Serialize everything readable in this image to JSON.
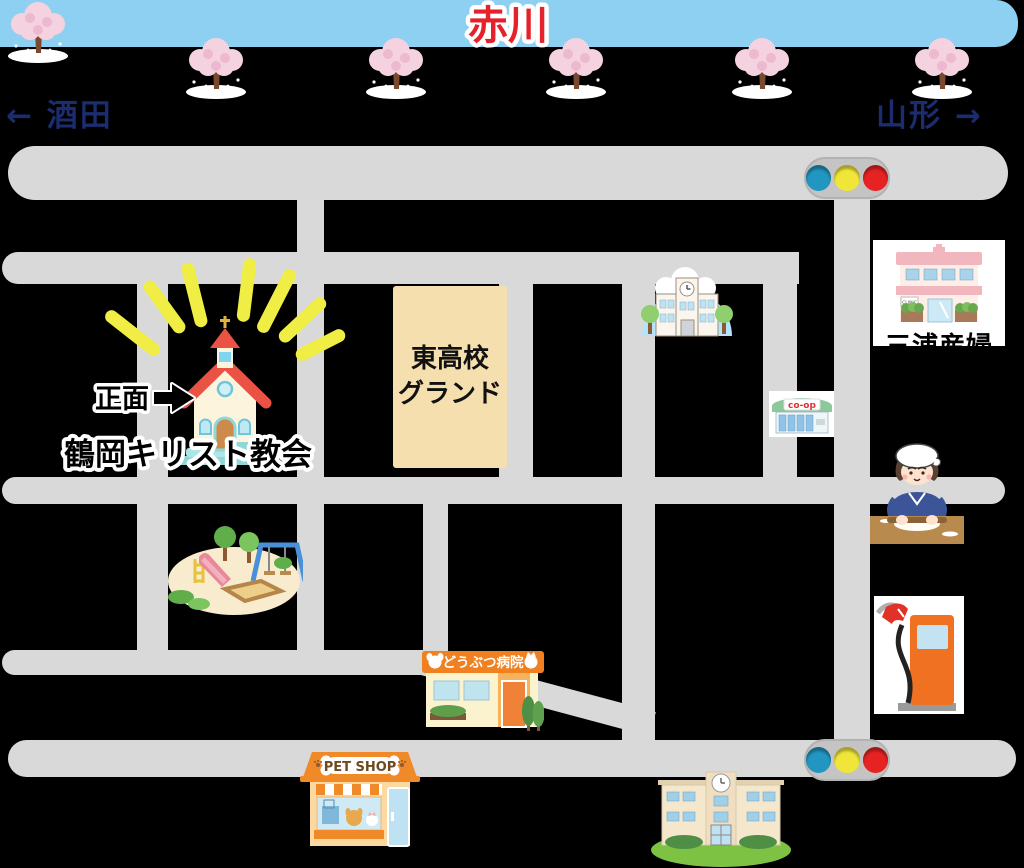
{
  "header": {
    "river": "赤川",
    "left_direction": "← 酒田",
    "right_direction": "山形 →"
  },
  "places": {
    "church": {
      "name": "鶴岡キリスト教会",
      "front_label": "正面"
    },
    "school_ground": {
      "line1": "東高校",
      "line2": "グランド"
    },
    "clinic": {
      "name": "三浦産婦",
      "small_sign": "CLINIC"
    },
    "coop": {
      "sign": "co-op"
    },
    "animal_hospital": {
      "sign": "どうぶつ病院"
    },
    "pet_shop": {
      "sign": "PET SHOP"
    }
  },
  "icons": [
    "cherry-tree-icon",
    "traffic-light-icon",
    "church-icon",
    "school-icon",
    "clinic-icon",
    "coop-store-icon",
    "soba-maker-icon",
    "gas-pump-icon",
    "playground-icon",
    "animal-hospital-icon",
    "pet-shop-icon",
    "school-building-icon"
  ],
  "colors": {
    "background": "#000000",
    "road": "#d9d9d9",
    "river_band": "#8ed0f2",
    "river_text": "#e5212b",
    "direction_text": "#1b2d6e",
    "ground_fill": "#f6dfae",
    "ray": "#f0ee44",
    "signal_housing": "#c4c4c4",
    "signal_blue": "#2196c0",
    "signal_yellow": "#f0e63a",
    "signal_red": "#e62222",
    "hospital_sign": "#f08020",
    "petshop_orange": "#f08a28",
    "label_text": "#111111"
  }
}
